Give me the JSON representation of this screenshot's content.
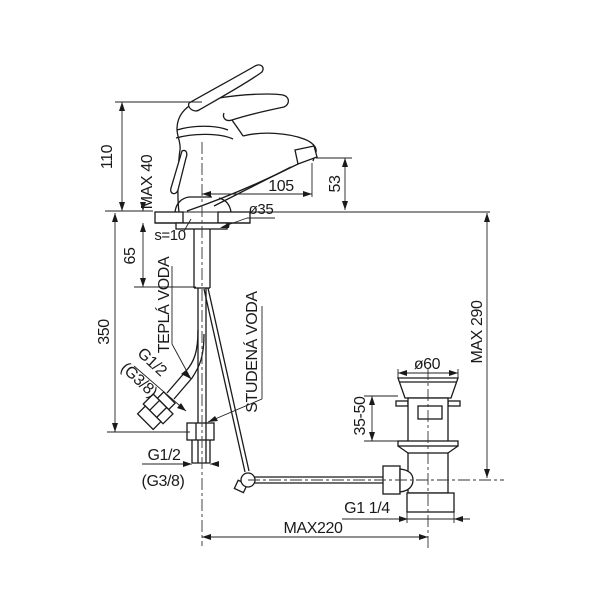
{
  "drawing": {
    "background": "#ffffff",
    "line_color": "#1a1a1a",
    "dimensions": {
      "body_height": "110",
      "deck_thickness_max": "MAX 40",
      "spout_reach": "105",
      "spout_height": "53",
      "hole_diameter": "ø35",
      "deck_thickness": "s=10",
      "shank_length": "65",
      "supply_length": "350",
      "hot_supply_thread": "G1/2",
      "hot_supply_thread_alt": "(G3/8)",
      "bottom_supply_thread": "G1/2",
      "bottom_supply_thread_alt": "(G3/8)",
      "max_height_drain": "MAX 290",
      "drain_flange_diameter": "ø60",
      "drain_adjust_range": "35-50",
      "drain_thread": "G1 1/4",
      "rod_reach_max": "MAX220"
    },
    "labels": {
      "hot_water": "TEPLÁ VODA",
      "cold_water": "STUDENÁ VODA"
    }
  }
}
